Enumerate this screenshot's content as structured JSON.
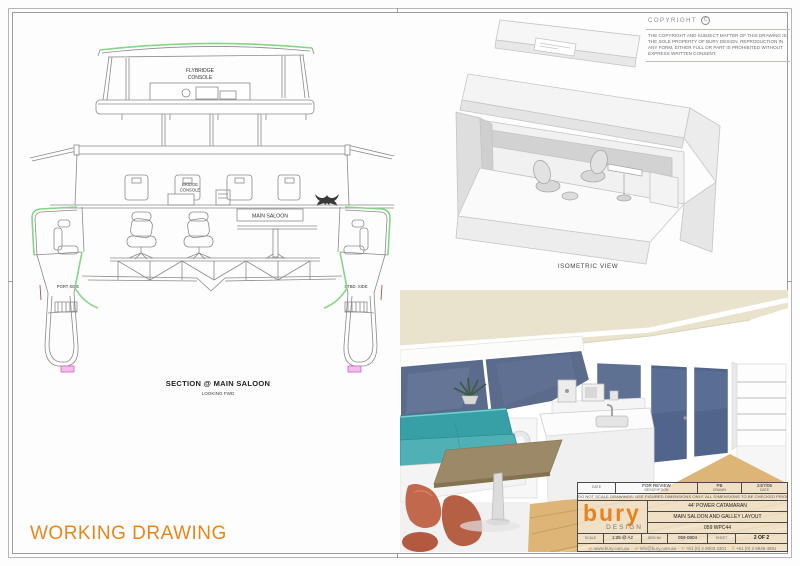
{
  "page": {
    "type_label": "WORKING DRAWING"
  },
  "copyright": {
    "heading": "COPYRIGHT",
    "symbol": "C",
    "body": "THE COPYRIGHT AND SUBJECT MATTER OF THIS DRAWING IS THE SOLE PROPERTY OF BURY DESIGN. REPRODUCTION IN ANY FORM, EITHER FULL OR PART IS PROHIBITED WITHOUT EXPRESS WRITTEN CONSENT."
  },
  "section_view": {
    "flybridge_line1": "FLYBRIDGE",
    "flybridge_line2": "CONSOLE",
    "bridge_line1": "BRIDGE",
    "bridge_line2": "CONSOLE",
    "main_saloon": "MAIN SALOON",
    "port": "PORT SIDE",
    "stbd": "STBD. SIDE",
    "title": "SECTION @ MAIN SALOON",
    "subtitle": "LOOKING FWD"
  },
  "isometric_view": {
    "label": "ISOMETRIC VIEW"
  },
  "title_block": {
    "revision": {
      "date_label": "DATE",
      "description_value": "FOR REVIEW",
      "description_label": "DESCRIPTION",
      "drawn_value": "PB",
      "drawn_label": "DRAWN",
      "date_value": "24/7/05",
      "date_label2": "DATE"
    },
    "disclaimer": "DO NOT SCALE DRAWINGS. USE FIGURED DIMENSIONS ONLY. ALL DIMENSIONS TO BE CHECKED PRIOR TO COMMENCEMENT OF CONSTRUCTION",
    "logo": {
      "name": "bury",
      "sub": "DESIGN"
    },
    "project": "44' POWER CATAMARAN",
    "drawing_title": "MAIN SALOON AND GALLEY LAYOUT",
    "project_no": "059 WPC44",
    "scale_label": "SCALE",
    "scale_value": "1:25 @ A2",
    "drg_label": "DRG No",
    "drg_value": "059-0804",
    "sheet_label": "SHEET",
    "sheet_value": "2 OF 2",
    "contact": [
      {
        "prefix": "w:",
        "value": "www.bury.com.au"
      },
      {
        "prefix": "e:",
        "value": "info@bury.com.au"
      },
      {
        "prefix": "t:",
        "value": "+61 (0) 2 9003 4301"
      },
      {
        "prefix": "f:",
        "value": "+61 (0) 2 9948 4891"
      }
    ]
  },
  "colors": {
    "accent_orange": "#E8821E",
    "cad_green": "#86D586",
    "cad_magenta": "#E06CC8",
    "window_blue": "#57688A",
    "sofa_teal": "#3FA7AC",
    "floor_wood": "#DCB577",
    "ceiling_cream": "#E9E3CE",
    "chair_terracotta": "#C2684D"
  }
}
